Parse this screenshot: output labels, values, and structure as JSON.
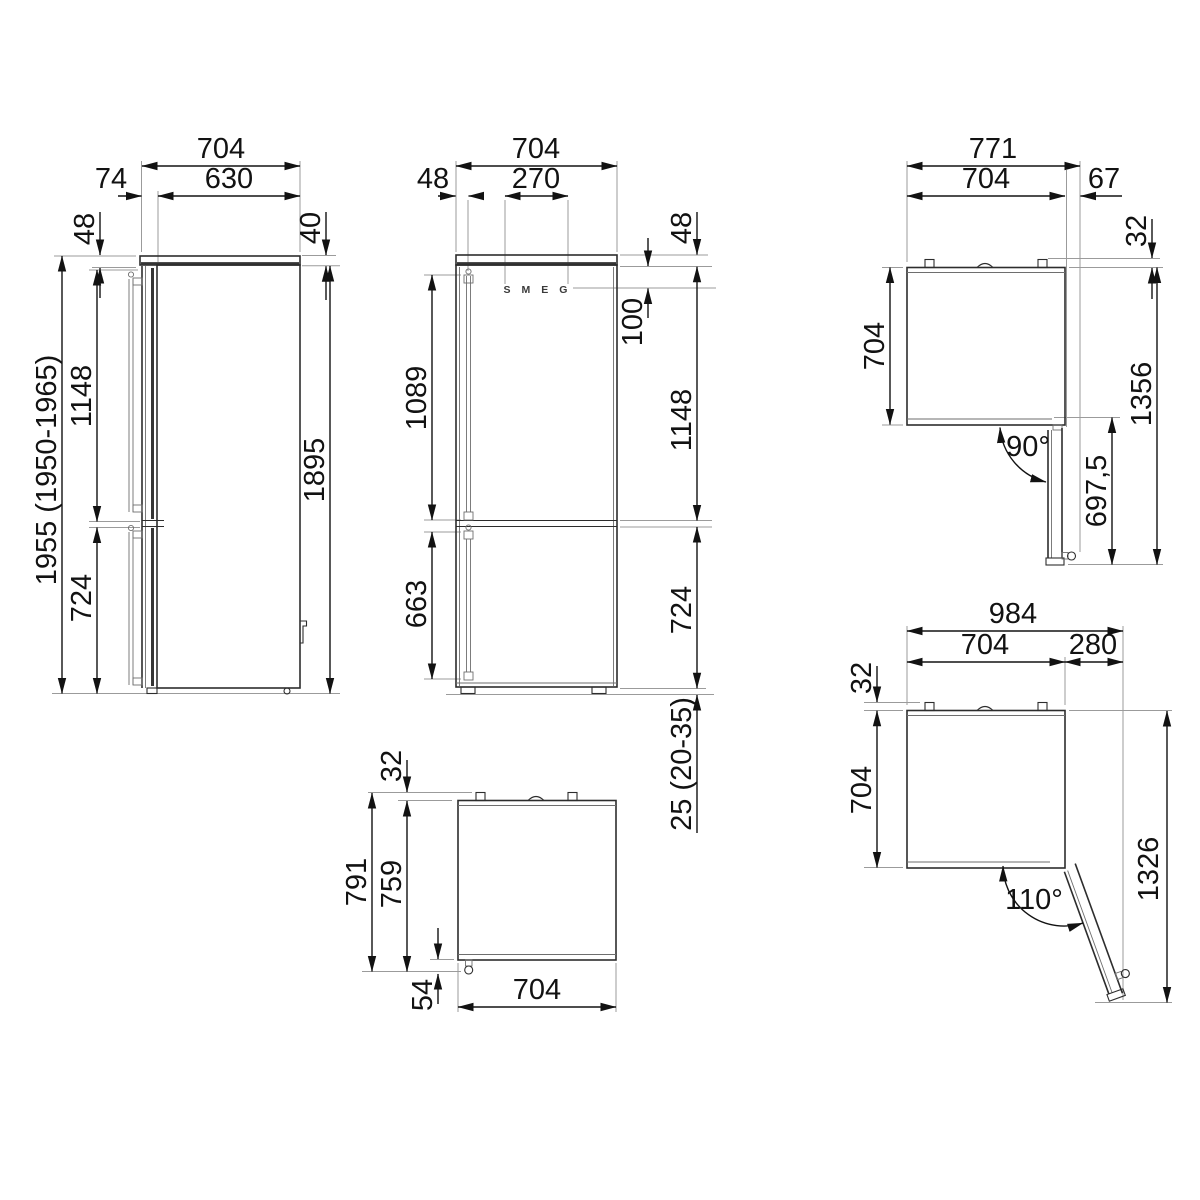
{
  "drawing": {
    "side": {
      "depth_total": "704",
      "depth_cabinet": "630",
      "door_front": "74",
      "top_gap": "48",
      "lid_height": "40",
      "upper_section": "1148",
      "lower_section": "724",
      "height_body": "1895",
      "height_total": "1955 (1950-1965)"
    },
    "front": {
      "width": "704",
      "logo_width": "270",
      "handle_inset": "48",
      "top_inset": "48",
      "logo_drop": "100",
      "upper_handle": "1089",
      "lower_handle": "663",
      "upper_section": "1148",
      "lower_section": "724",
      "feet_height": "25 (20-35)",
      "logo": "SMEG"
    },
    "top90": {
      "width_total": "771",
      "depth": "704",
      "door_side": "67",
      "spacer": "32",
      "depth_left": "704",
      "door_reach": "697,5",
      "diagonal_total": "1356",
      "angle": "90°"
    },
    "topClosed": {
      "spacer": "32",
      "depth_hinges": "791",
      "depth_handle": "759",
      "handle_depth": "54",
      "width": "704"
    },
    "top110": {
      "width_total": "984",
      "depth": "704",
      "door_side": "280",
      "spacer": "32",
      "depth_left": "704",
      "diagonal_total": "1326",
      "angle": "110°"
    }
  }
}
